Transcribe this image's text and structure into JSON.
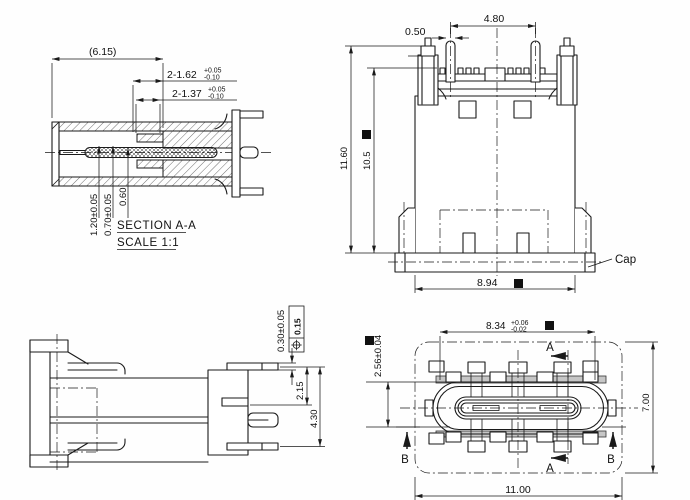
{
  "views": {
    "section": {
      "title": "SECTION A-A",
      "scale": "SCALE 1:1",
      "dim_overall": "(6.15)",
      "slot1": {
        "value": "2-1.62",
        "upper": "+0.05",
        "lower": "-0.10"
      },
      "slot2": {
        "value": "2-1.37",
        "upper": "+0.05",
        "lower": "-0.10"
      },
      "dim_v1": "1.20±0.05",
      "dim_v2": "0.70±0.05",
      "dim_v3": "0.60"
    },
    "front": {
      "dim_pitch": "4.80",
      "dim_pin": "0.50",
      "dim_h_overall": "11.60",
      "dim_h_body": "10.5",
      "dim_w_body": "8.94",
      "cap_label": "Cap"
    },
    "side": {
      "dim_lead": "0.30±0.05",
      "gdt_value": "0.15",
      "dim_lead_height": "2.15",
      "dim_overall_height": "4.30"
    },
    "top": {
      "shell_w": {
        "value": "8.34",
        "upper": "+0.06",
        "lower": "-0.02"
      },
      "dim_shell_h": "2.56±0.04",
      "dim_depth": "7.00",
      "dim_w": "11.00",
      "mark_a": "A",
      "mark_b": "B"
    }
  },
  "colors": {
    "line": "#1a1a1a",
    "background": "#ffffff",
    "shade": "#c6c6c6"
  }
}
